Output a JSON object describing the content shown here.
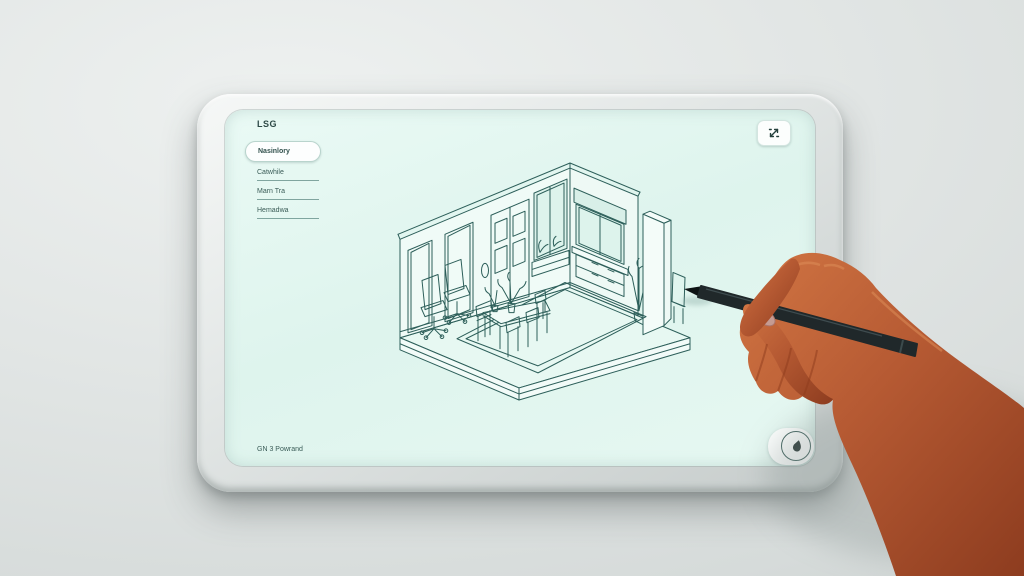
{
  "screen": {
    "brand": "LSG",
    "sidebar": {
      "items": [
        {
          "label": "Nasinlory",
          "selected": true
        },
        {
          "label": "Catwhile",
          "selected": false
        },
        {
          "label": "Marn Tra",
          "selected": false
        },
        {
          "label": "Hemadwa",
          "selected": false
        }
      ]
    },
    "toolbar": {
      "expand_icon": "expand-arrows-icon"
    },
    "canvas": {
      "subject": "isometric room interior line drawing"
    },
    "footer": {
      "caption": "GN 3 Powrand",
      "logo_icon": "pen-drop-icon"
    }
  },
  "overlay": {
    "hand": "hand-holding-stylus",
    "stylus": "black-stylus-pen"
  },
  "colors": {
    "background": "#dfe3e2",
    "bezel": "#e8ecea",
    "screen": "#e3f6f0",
    "line_art": "#2d5f5a",
    "text": "#2e4a47",
    "pen": "#20282a",
    "skin": "#b65a33",
    "nail": "#c59b92"
  }
}
